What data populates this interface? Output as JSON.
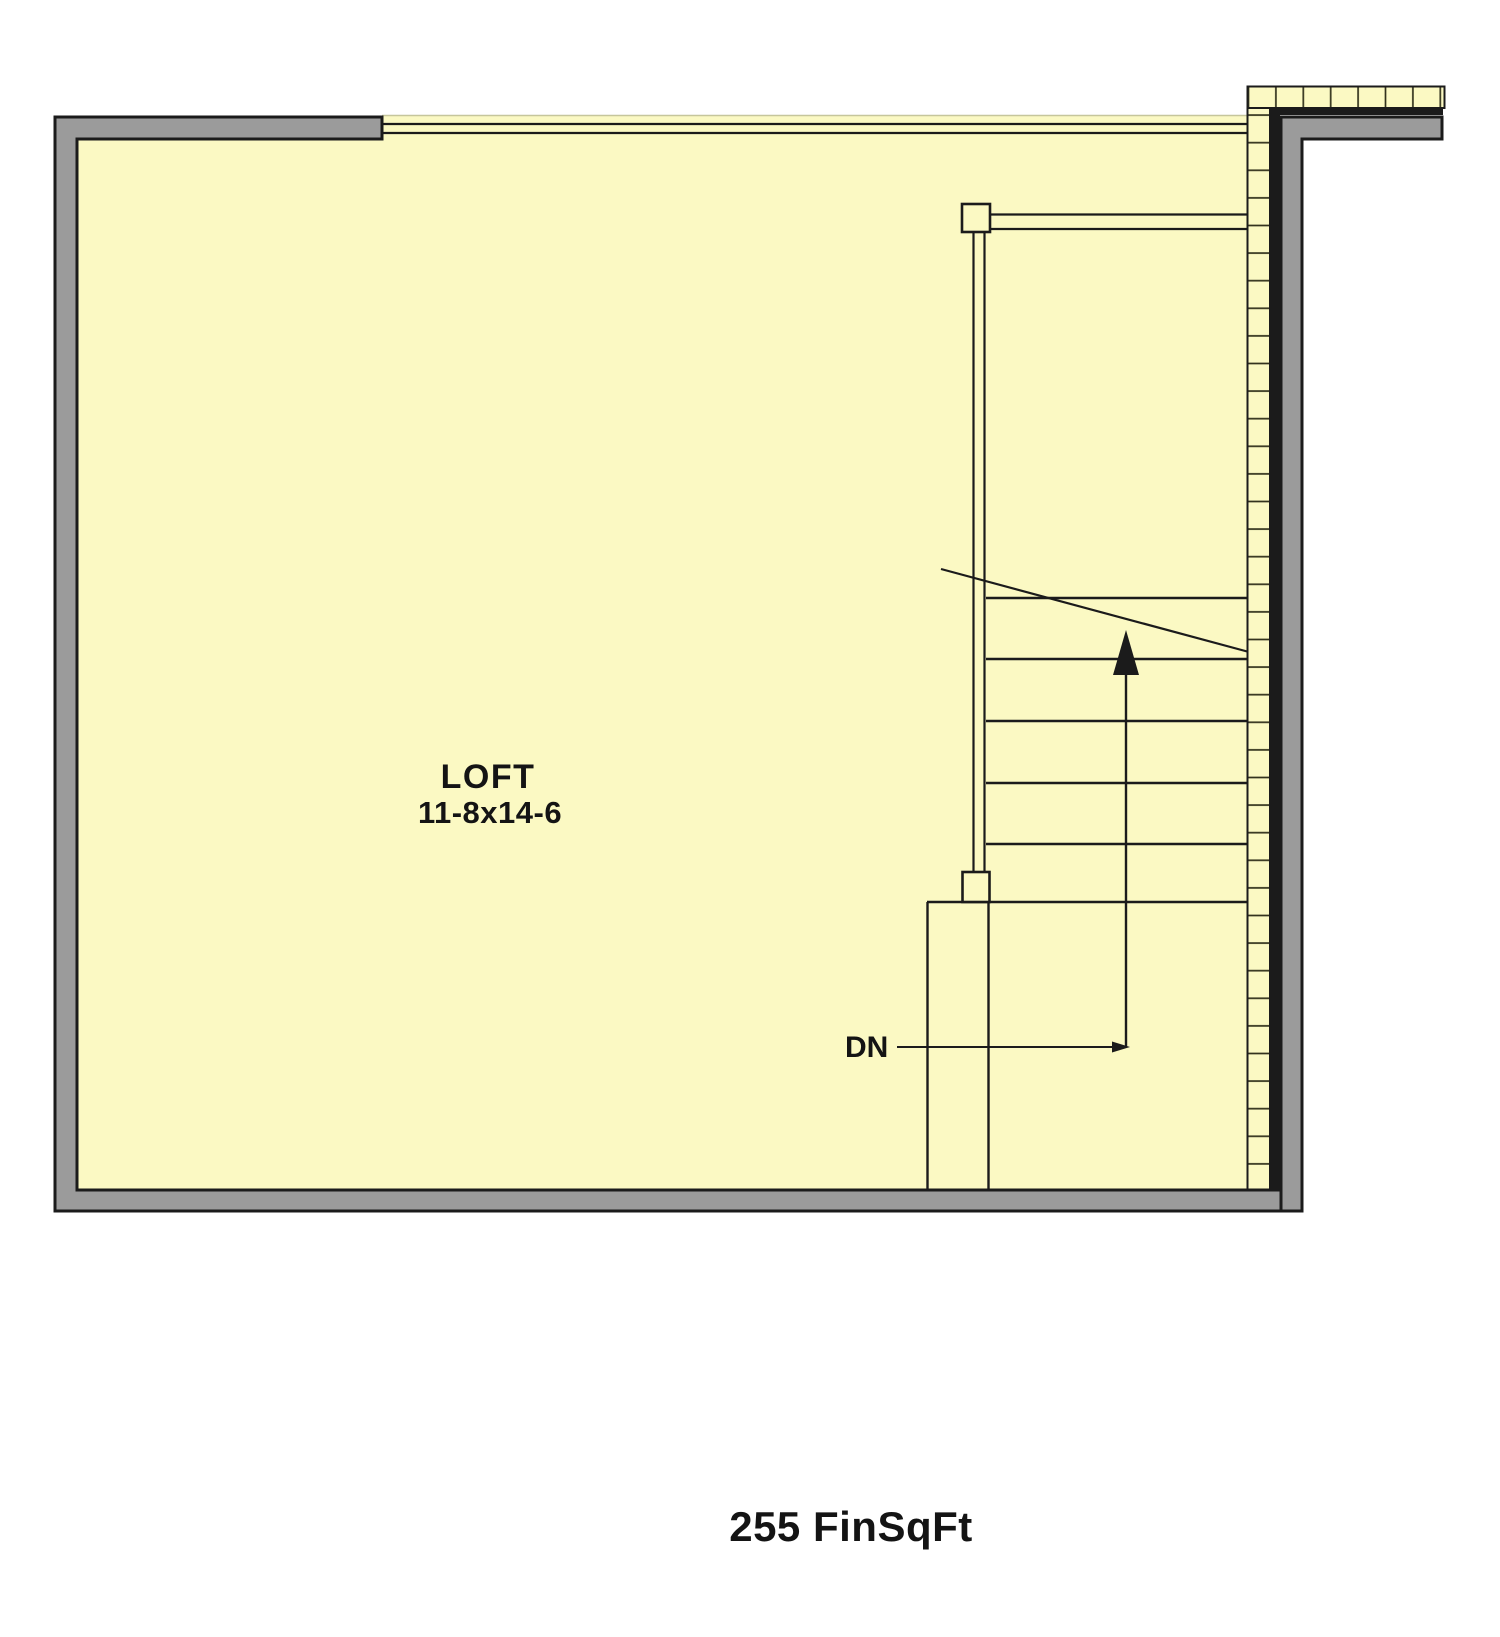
{
  "plan": {
    "room_label": "LOFT",
    "room_dimensions": "11-8x14-6",
    "stair_direction_label": "DN",
    "area_label": "255 FinSqFt"
  },
  "colors": {
    "floor_fill": "#FBF9C3",
    "wall_fill": "#9B9B9B",
    "line": "#1B1B1B",
    "hatch_tick": "#32321C",
    "open_edge_light": "#C6C69C",
    "background": "#FFFFFF"
  }
}
